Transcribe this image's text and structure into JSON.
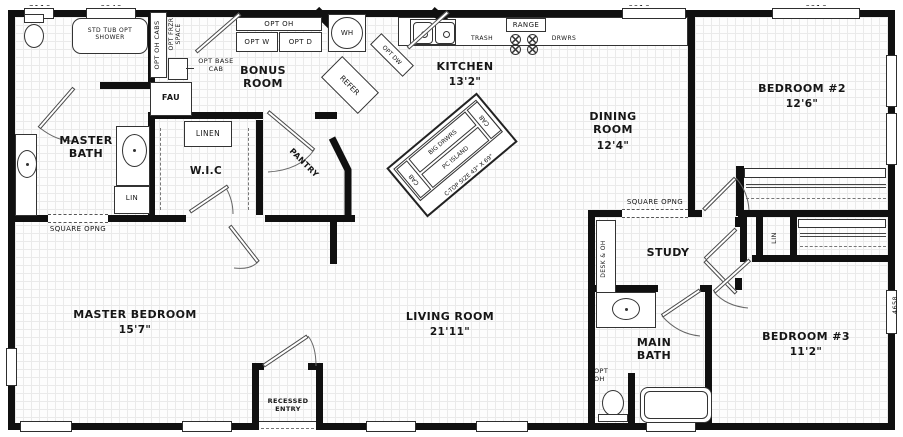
{
  "rooms": {
    "master_bath": {
      "name": "MASTER BATH"
    },
    "wic": {
      "name": "W.I.C"
    },
    "bonus": {
      "name": "BONUS ROOM"
    },
    "pantry": {
      "name": "PANTRY"
    },
    "kitchen": {
      "name": "KITCHEN",
      "dim": "13'2\""
    },
    "dining": {
      "name": "DINING ROOM",
      "dim": "12'4\""
    },
    "bedroom2": {
      "name": "BEDROOM #2",
      "dim": "12'6\""
    },
    "study": {
      "name": "STUDY"
    },
    "main_bath": {
      "name": "MAIN BATH"
    },
    "bedroom3": {
      "name": "BEDROOM #3",
      "dim": "11'2\""
    },
    "living": {
      "name": "LIVING ROOM",
      "dim": "21'11\""
    },
    "master_bedroom": {
      "name": "MASTER BEDROOM",
      "dim": "15'7\""
    },
    "entry": {
      "name": "RECESSED ENTRY"
    }
  },
  "callouts": {
    "tub": "STD TUB OPT SHOWER",
    "opt_oh_cabs": "OPT OH CABS",
    "opt_frzr": "OPT FRZR SPACE",
    "opt_base": "OPT BASE CAB",
    "fau": "FAU",
    "linen": "LINEN",
    "lin_master": "LIN",
    "lin_hall": "LIN",
    "square_opng_left": "SQUARE OPNG",
    "square_opng_right": "SQUARE OPNG",
    "opt_oh_laundry": "OPT OH",
    "opt_w": "OPT W",
    "opt_d": "OPT D",
    "wh": "WH",
    "refer": "REFER",
    "opt_dw": "OPT DW",
    "trash": "TRASH",
    "range": "RANGE",
    "drwrs": "DRWRS",
    "desk": "DESK & OH",
    "opt_oh_bath": "OPT OH"
  },
  "island": {
    "big_drwrs": "BIG DRWRS",
    "cab_left": "CAB",
    "cab_right": "CAB",
    "pc_island": "PC ISLAND",
    "ctop": "C-TOP SIZE 43\" X 69\""
  },
  "window_labels": {
    "top_a": "3110",
    "top_b": "6040",
    "top_c": "6016",
    "top_d": "6016",
    "side": "4658"
  },
  "colors": {
    "wall": "#101010",
    "line": "#333333",
    "grid": "#eaeaea",
    "text": "#161616"
  }
}
